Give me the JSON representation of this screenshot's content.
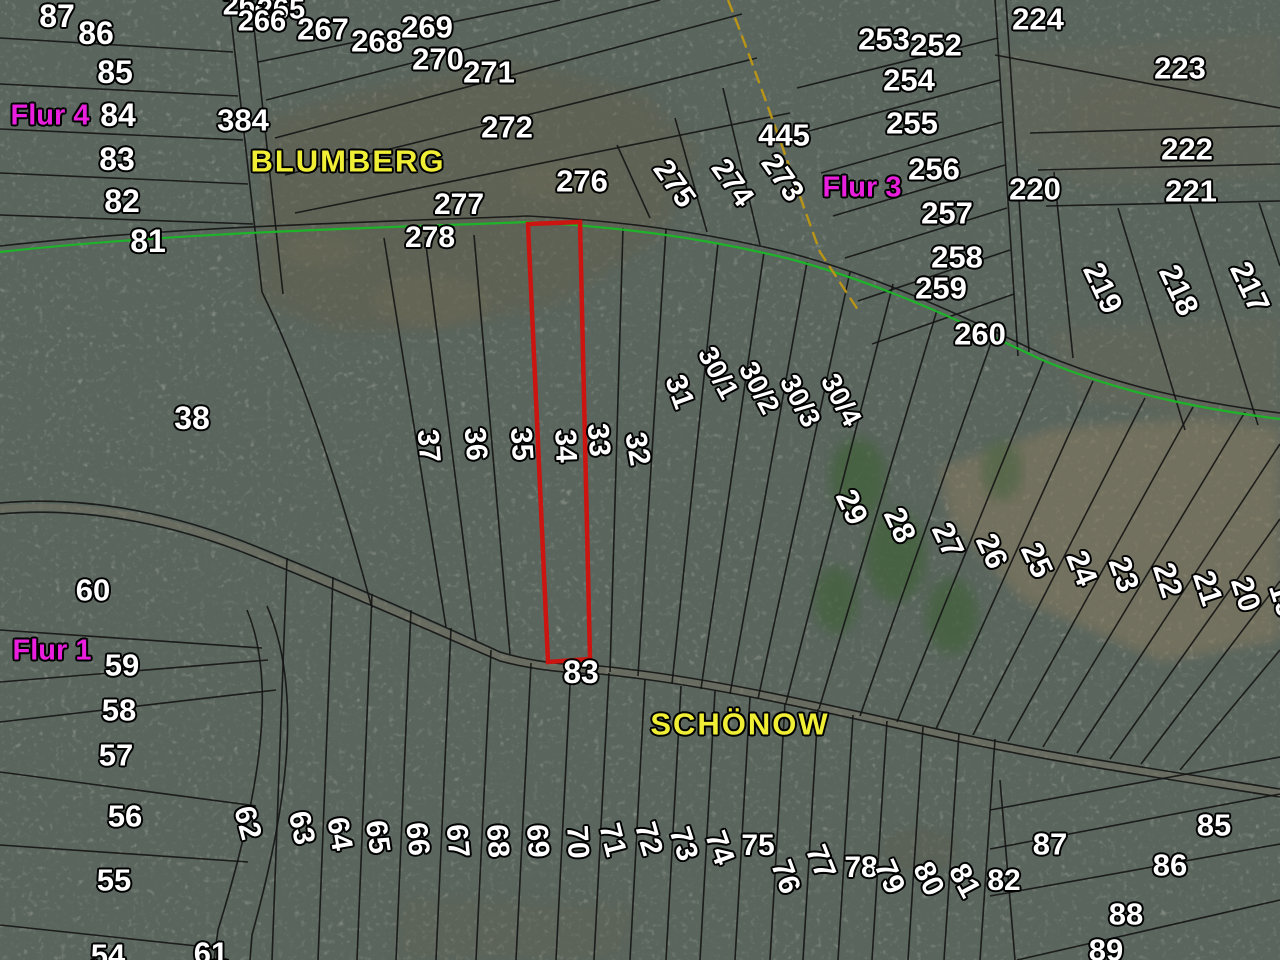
{
  "map": {
    "highlighted_parcel": "34",
    "colors": {
      "parcel_number_text": "#ffffff",
      "place_name_text": "#f0ee35",
      "flur_label_text": "#ea1fdd",
      "boundary_line": "#141414",
      "municipal_boundary_green": "#1eb42a",
      "district_boundary_yellow": "#b99517",
      "highlight_parcel_red": "#cc1410",
      "forest_base": "#39423c"
    },
    "place_labels": [
      {
        "t": "BLUMBERG",
        "x": 348,
        "y": 161,
        "r": 0,
        "s": 31,
        "c": "y"
      },
      {
        "t": "SCHÖNOW",
        "x": 740,
        "y": 724,
        "r": 0,
        "s": 31,
        "c": "y"
      }
    ],
    "flur_labels": [
      {
        "t": "Flur 4",
        "x": 50,
        "y": 116,
        "r": 0,
        "s": 29,
        "c": "m"
      },
      {
        "t": "Flur 3",
        "x": 862,
        "y": 188,
        "r": 0,
        "s": 29,
        "c": "m"
      },
      {
        "t": "Flur 1",
        "x": 52,
        "y": 651,
        "r": 0,
        "s": 29,
        "c": "m"
      }
    ],
    "parcel_labels": [
      {
        "t": "87",
        "x": 57,
        "y": 16
      },
      {
        "t": "86",
        "x": 96,
        "y": 33
      },
      {
        "t": "85",
        "x": 115,
        "y": 72
      },
      {
        "t": "84",
        "x": 118,
        "y": 115
      },
      {
        "t": "384",
        "x": 243,
        "y": 120,
        "s": 31
      },
      {
        "t": "83",
        "x": 117,
        "y": 159
      },
      {
        "t": "82",
        "x": 122,
        "y": 201
      },
      {
        "t": "81",
        "x": 148,
        "y": 241
      },
      {
        "t": "264",
        "x": 247,
        "y": 6,
        "s": 29
      },
      {
        "t": "265",
        "x": 281,
        "y": 10,
        "s": 29
      },
      {
        "t": "266",
        "x": 262,
        "y": 22,
        "s": 29
      },
      {
        "t": "267",
        "x": 323,
        "y": 29,
        "s": 31
      },
      {
        "t": "268",
        "x": 377,
        "y": 41,
        "s": 31
      },
      {
        "t": "269",
        "x": 427,
        "y": 27,
        "s": 31
      },
      {
        "t": "270",
        "x": 438,
        "y": 59,
        "s": 31
      },
      {
        "t": "271",
        "x": 489,
        "y": 72,
        "s": 31
      },
      {
        "t": "272",
        "x": 507,
        "y": 127,
        "s": 31
      },
      {
        "t": "277",
        "x": 459,
        "y": 205,
        "s": 30
      },
      {
        "t": "278",
        "x": 430,
        "y": 238,
        "s": 30
      },
      {
        "t": "276",
        "x": 582,
        "y": 181,
        "s": 31
      },
      {
        "t": "275",
        "x": 674,
        "y": 184,
        "r": 55,
        "s": 30
      },
      {
        "t": "274",
        "x": 732,
        "y": 183,
        "r": 55,
        "s": 30
      },
      {
        "t": "273",
        "x": 782,
        "y": 178,
        "r": 55,
        "s": 30
      },
      {
        "t": "445",
        "x": 784,
        "y": 135,
        "s": 31
      },
      {
        "t": "253",
        "x": 884,
        "y": 39,
        "s": 31
      },
      {
        "t": "252",
        "x": 936,
        "y": 45,
        "s": 31
      },
      {
        "t": "254",
        "x": 909,
        "y": 80,
        "s": 31
      },
      {
        "t": "255",
        "x": 912,
        "y": 123,
        "s": 31
      },
      {
        "t": "256",
        "x": 934,
        "y": 169,
        "s": 31
      },
      {
        "t": "257",
        "x": 947,
        "y": 213,
        "s": 31
      },
      {
        "t": "258",
        "x": 957,
        "y": 257,
        "s": 31
      },
      {
        "t": "259",
        "x": 941,
        "y": 288,
        "s": 31
      },
      {
        "t": "260",
        "x": 980,
        "y": 334,
        "s": 31
      },
      {
        "t": "224",
        "x": 1038,
        "y": 19,
        "s": 31
      },
      {
        "t": "223",
        "x": 1180,
        "y": 68,
        "s": 31
      },
      {
        "t": "222",
        "x": 1187,
        "y": 149,
        "s": 31
      },
      {
        "t": "221",
        "x": 1191,
        "y": 191,
        "s": 31
      },
      {
        "t": "220",
        "x": 1035,
        "y": 189,
        "s": 31
      },
      {
        "t": "219",
        "x": 1103,
        "y": 288,
        "r": 65,
        "s": 31
      },
      {
        "t": "218",
        "x": 1179,
        "y": 290,
        "r": 65,
        "s": 31
      },
      {
        "t": "217",
        "x": 1250,
        "y": 287,
        "r": 65,
        "s": 31
      },
      {
        "t": "38",
        "x": 192,
        "y": 418
      },
      {
        "t": "37",
        "x": 428,
        "y": 446,
        "r": 85,
        "s": 30
      },
      {
        "t": "36",
        "x": 475,
        "y": 444,
        "r": 85,
        "s": 30
      },
      {
        "t": "35",
        "x": 521,
        "y": 444,
        "r": 86,
        "s": 30
      },
      {
        "t": "34",
        "x": 565,
        "y": 446,
        "r": 88,
        "s": 30
      },
      {
        "t": "33",
        "x": 598,
        "y": 440,
        "r": 85,
        "s": 30
      },
      {
        "t": "32",
        "x": 637,
        "y": 449,
        "r": 80,
        "s": 30
      },
      {
        "t": "31",
        "x": 679,
        "y": 392,
        "r": 70,
        "s": 30
      },
      {
        "t": "30/1",
        "x": 718,
        "y": 373,
        "r": 62,
        "s": 28
      },
      {
        "t": "30/2",
        "x": 759,
        "y": 388,
        "r": 62,
        "s": 28
      },
      {
        "t": "30/3",
        "x": 800,
        "y": 401,
        "r": 62,
        "s": 28
      },
      {
        "t": "30/4",
        "x": 841,
        "y": 400,
        "r": 62,
        "s": 28
      },
      {
        "t": "29",
        "x": 852,
        "y": 507,
        "r": 65,
        "s": 31
      },
      {
        "t": "28",
        "x": 900,
        "y": 525,
        "r": 65,
        "s": 31
      },
      {
        "t": "27",
        "x": 948,
        "y": 540,
        "r": 65,
        "s": 31
      },
      {
        "t": "26",
        "x": 992,
        "y": 551,
        "r": 65,
        "s": 31
      },
      {
        "t": "25",
        "x": 1037,
        "y": 560,
        "r": 65,
        "s": 31
      },
      {
        "t": "24",
        "x": 1082,
        "y": 568,
        "r": 68,
        "s": 31
      },
      {
        "t": "23",
        "x": 1124,
        "y": 574,
        "r": 70,
        "s": 31
      },
      {
        "t": "22",
        "x": 1168,
        "y": 580,
        "r": 72,
        "s": 31
      },
      {
        "t": "21",
        "x": 1208,
        "y": 588,
        "r": 72,
        "s": 31
      },
      {
        "t": "20",
        "x": 1246,
        "y": 594,
        "r": 72,
        "s": 31
      },
      {
        "t": "19",
        "x": 1284,
        "y": 600,
        "r": 72,
        "s": 31
      },
      {
        "t": "60",
        "x": 93,
        "y": 590,
        "s": 31
      },
      {
        "t": "59",
        "x": 122,
        "y": 665,
        "s": 31
      },
      {
        "t": "58",
        "x": 119,
        "y": 710,
        "s": 31
      },
      {
        "t": "57",
        "x": 116,
        "y": 755,
        "s": 31
      },
      {
        "t": "56",
        "x": 125,
        "y": 816,
        "s": 31
      },
      {
        "t": "55",
        "x": 114,
        "y": 880,
        "s": 31
      },
      {
        "t": "54",
        "x": 108,
        "y": 955,
        "s": 31
      },
      {
        "t": "61",
        "x": 211,
        "y": 953,
        "s": 31
      },
      {
        "t": "62",
        "x": 247,
        "y": 823,
        "r": 75,
        "s": 30
      },
      {
        "t": "63",
        "x": 301,
        "y": 828,
        "r": 78,
        "s": 30
      },
      {
        "t": "64",
        "x": 339,
        "y": 834,
        "r": 80,
        "s": 30
      },
      {
        "t": "65",
        "x": 377,
        "y": 837,
        "r": 82,
        "s": 30
      },
      {
        "t": "66",
        "x": 417,
        "y": 839,
        "r": 84,
        "s": 30
      },
      {
        "t": "67",
        "x": 457,
        "y": 841,
        "r": 85,
        "s": 30
      },
      {
        "t": "68",
        "x": 497,
        "y": 841,
        "r": 86,
        "s": 30
      },
      {
        "t": "69",
        "x": 537,
        "y": 841,
        "r": 86,
        "s": 30
      },
      {
        "t": "70",
        "x": 577,
        "y": 842,
        "r": 87,
        "s": 30
      },
      {
        "t": "71",
        "x": 612,
        "y": 840,
        "r": 76,
        "s": 30
      },
      {
        "t": "72",
        "x": 648,
        "y": 839,
        "r": 74,
        "s": 30
      },
      {
        "t": "73",
        "x": 683,
        "y": 844,
        "r": 72,
        "s": 30
      },
      {
        "t": "74",
        "x": 719,
        "y": 848,
        "r": 70,
        "s": 30
      },
      {
        "t": "75",
        "x": 758,
        "y": 846,
        "s": 30
      },
      {
        "t": "76",
        "x": 785,
        "y": 877,
        "r": 70,
        "s": 30
      },
      {
        "t": "77",
        "x": 820,
        "y": 862,
        "r": 68,
        "s": 30
      },
      {
        "t": "78",
        "x": 861,
        "y": 868,
        "s": 30
      },
      {
        "t": "79",
        "x": 889,
        "y": 877,
        "r": 66,
        "s": 30
      },
      {
        "t": "80",
        "x": 928,
        "y": 879,
        "r": 64,
        "s": 30
      },
      {
        "t": "81",
        "x": 964,
        "y": 881,
        "r": 62,
        "s": 30
      },
      {
        "t": "82",
        "x": 1004,
        "y": 881,
        "s": 30
      },
      {
        "t": "83",
        "x": 581,
        "y": 672
      },
      {
        "t": "85",
        "x": 1214,
        "y": 825,
        "s": 31
      },
      {
        "t": "86",
        "x": 1170,
        "y": 865,
        "s": 31
      },
      {
        "t": "87",
        "x": 1050,
        "y": 844,
        "s": 31
      },
      {
        "t": "88",
        "x": 1126,
        "y": 914,
        "s": 31
      },
      {
        "t": "89",
        "x": 1106,
        "y": 950,
        "s": 31
      }
    ],
    "boundaries": {
      "black": [
        "M0,38 L233,52",
        "M0,84 L238,96",
        "M0,129 L243,140",
        "M0,173 L248,184",
        "M0,215 L253,224",
        "M229,0 L262,292",
        "M251,0 L283,294",
        "M262,292 C300,370 335,470 372,608",
        "M258,62 L560,0",
        "M266,100 L660,0",
        "M275,138 L742,14",
        "M285,175 L757,58",
        "M295,213 L790,113",
        "M617,145 L650,218",
        "M675,118 L707,232",
        "M723,88 L760,245",
        "M797,88 L998,38",
        "M809,131 L1000,80",
        "M821,173 L1002,122",
        "M833,216 L1005,165",
        "M845,258 L1007,208",
        "M858,301 L1010,250",
        "M872,344 L1014,294",
        "M995,0 L1018,356",
        "M1006,0 L1029,352",
        "M995,55 L1280,108",
        "M1030,133 L1280,126",
        "M1038,170 L1280,164",
        "M1046,206 L1280,201",
        "M1054,172 L1073,358",
        "M1118,208 L1185,430",
        "M1190,205 L1258,425",
        "M1259,203 L1280,266",
        "M384,238 L446,627",
        "M425,237 L476,641",
        "M474,235 L510,654",
        "M623,228 L610,672",
        "M666,229 L638,676",
        "M718,243 L672,684",
        "M764,252 L701,689",
        "M807,262 L730,694",
        "M850,272 L758,699",
        "M893,284 L786,703",
        "M937,310 L819,709",
        "M993,337 L860,716",
        "M1044,360 L897,722",
        "M1093,381 L936,729",
        "M1145,398 L973,735",
        "M1193,407 L1008,741",
        "M1245,412 L1043,747",
        "M1280,444 L1077,753",
        "M1280,519 L1110,759",
        "M1280,581 L1141,764",
        "M1280,650 L1180,770",
        "M0,630 L262,648",
        "M0,682 L268,660",
        "M0,722 L276,690",
        "M0,772 L256,806",
        "M0,845 L248,862",
        "M0,925 L216,948",
        "M247,610 C280,690 255,810 218,930 L214,960",
        "M267,606 C305,695 285,815 252,935 L250,960",
        "M287,558 L272,960",
        "M333,577 L318,960",
        "M372,594 L357,960",
        "M411,610 L396,960",
        "M451,628 L436,960",
        "M491,650 L476,960",
        "M531,663 L516,960",
        "M571,666 L556,960",
        "M609,673 L594,960",
        "M645,679 L630,960",
        "M681,686 L666,960",
        "M715,691 L700,960",
        "M750,697 L735,960",
        "M785,703 L770,960",
        "M818,709 L803,960",
        "M853,715 L838,960",
        "M887,721 L872,960",
        "M923,727 L908,960",
        "M959,733 L944,960",
        "M995,739 L980,960",
        "M990,810 L1280,757",
        "M990,849 L1280,794",
        "M990,896 L1280,844",
        "M1017,960 L1280,900",
        "M1000,780 L1015,960",
        "M0,246 C180,226 380,222 528,216 C620,221 700,231 790,253 C880,277 960,315 1040,353 C1120,387 1200,403 1280,413"
      ],
      "roads": [
        "M0,503 C90,495 180,515 260,548 C340,580 430,620 500,652 C530,661 560,665 600,666",
        "M0,514 C90,506 180,526 260,559 C340,591 430,631 500,661 C530,669 562,673 600,674",
        "M600,666 C720,678 840,708 960,734 C1070,757 1180,773 1280,789",
        "M600,674 C720,686 840,716 960,742 C1070,765 1180,781 1280,797"
      ],
      "road_glow": [
        "M0,509 C90,501 180,521 260,554 C340,586 430,626 500,657 C545,668 570,670 600,670",
        "M600,670 C720,682 840,712 960,738 C1070,761 1180,777 1280,793"
      ],
      "green": "M0,252 C180,232 380,228 528,222 C620,227 700,237 790,259 C880,283 960,321 1040,359 C1120,393 1200,409 1280,419",
      "yellow_dashed": "M728,0 C752,60 786,158 820,252 L858,310",
      "red_parcel": "M528,224 L580,222 L590,659 L548,662 Z"
    },
    "terrain": {
      "clearings": [
        {
          "pts": "255,300 268,118 360,90 510,58 645,92 700,150 665,235 560,305 430,332 330,332",
          "fill": "#635f4d",
          "op": 0.45
        },
        {
          "pts": "1000,52 1280,32 1280,178 1085,188 1008,150",
          "fill": "#6d6856",
          "op": 0.32
        },
        {
          "pts": "1045,328 1280,318 1280,424 1078,402",
          "fill": "#6d6856",
          "op": 0.35
        },
        {
          "pts": "938,468 1055,428 1200,418 1280,428 1280,640 1162,662 1022,600 950,520",
          "fill": "#8b7b5e",
          "op": 0.5
        },
        {
          "pts": "400,895 640,905 620,960 396,960",
          "fill": "#66624f",
          "op": 0.25
        }
      ],
      "blobs": [
        {
          "x": 858,
          "y": 478,
          "rx": 28,
          "ry": 40,
          "fill": "#42603a",
          "op": 0.75
        },
        {
          "x": 896,
          "y": 556,
          "rx": 30,
          "ry": 46,
          "fill": "#42603a",
          "op": 0.75
        },
        {
          "x": 952,
          "y": 616,
          "rx": 26,
          "ry": 38,
          "fill": "#42603a",
          "op": 0.7
        },
        {
          "x": 836,
          "y": 600,
          "rx": 22,
          "ry": 34,
          "fill": "#42603a",
          "op": 0.7
        },
        {
          "x": 1002,
          "y": 470,
          "rx": 20,
          "ry": 30,
          "fill": "#4a6340",
          "op": 0.6
        },
        {
          "x": 430,
          "y": 300,
          "rx": 60,
          "ry": 25,
          "fill": "#736d55",
          "op": 0.35
        },
        {
          "x": 320,
          "y": 250,
          "rx": 40,
          "ry": 18,
          "fill": "#736d55",
          "op": 0.3
        },
        {
          "x": 560,
          "y": 180,
          "rx": 50,
          "ry": 20,
          "fill": "#736d55",
          "op": 0.3
        },
        {
          "x": 920,
          "y": 850,
          "rx": 40,
          "ry": 22,
          "fill": "#5e5a49",
          "op": 0.3
        },
        {
          "x": 1150,
          "y": 120,
          "rx": 80,
          "ry": 40,
          "fill": "#6a6452",
          "op": 0.25
        }
      ]
    }
  }
}
